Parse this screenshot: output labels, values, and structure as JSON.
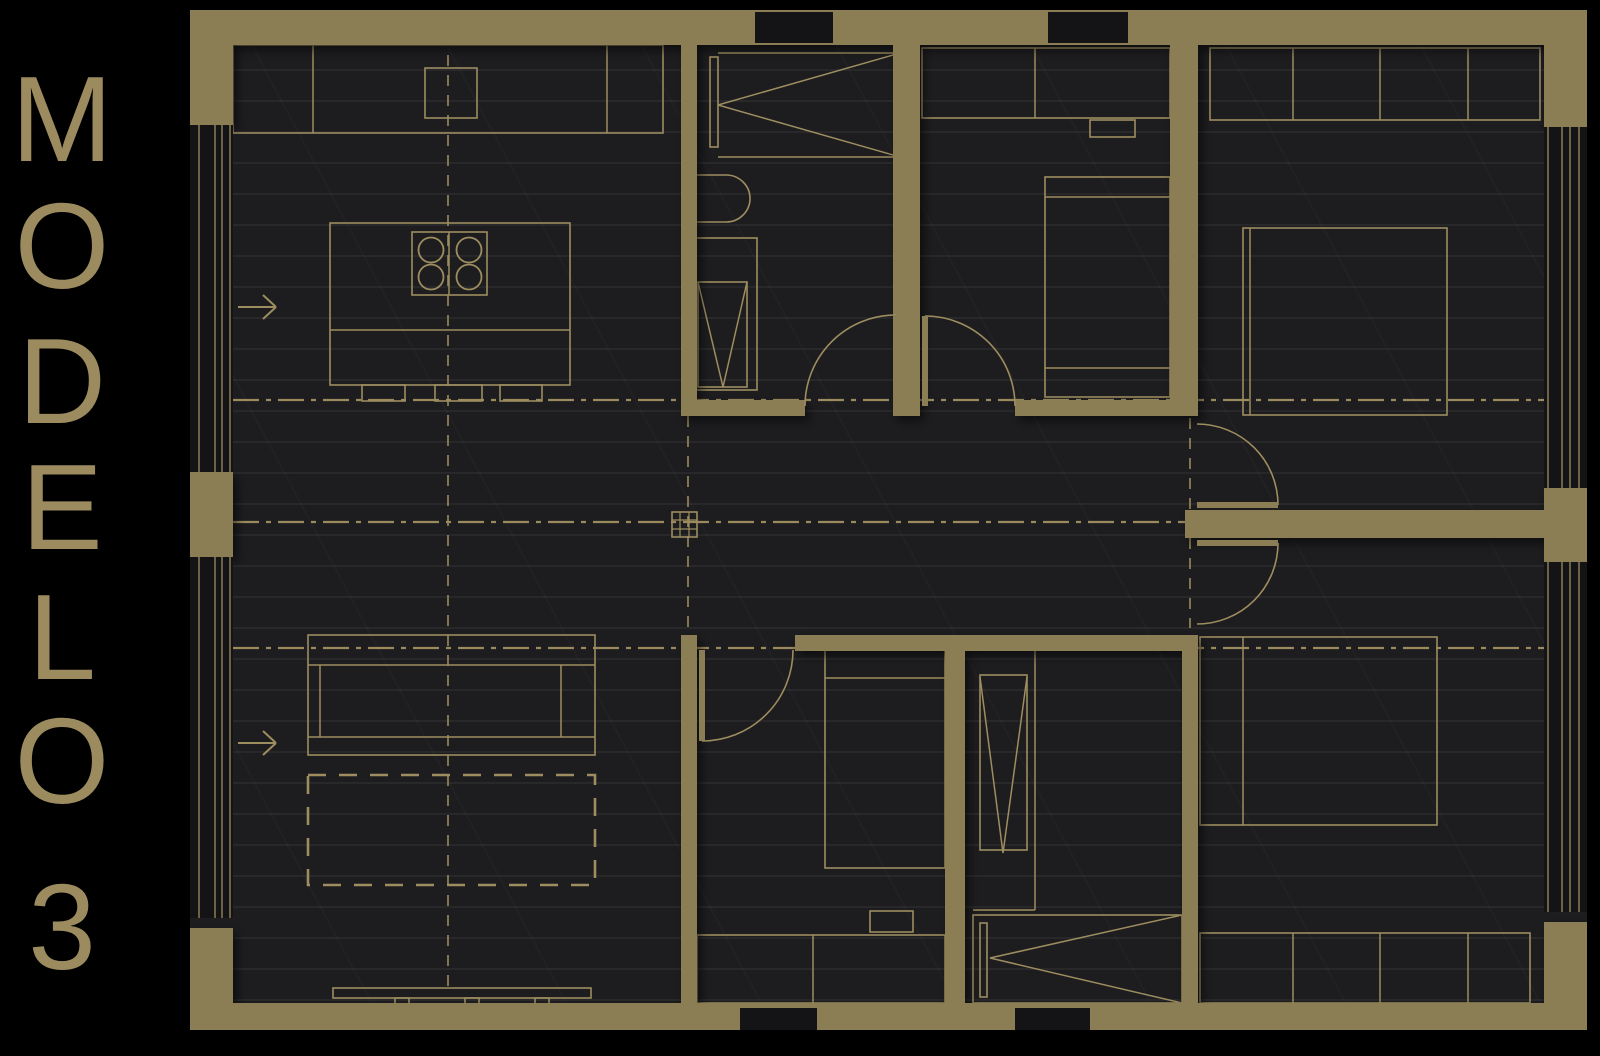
{
  "title": {
    "text": "MODELO 3",
    "color": "#9c8b5e",
    "letters": [
      {
        "ch": "M",
        "y": 58
      },
      {
        "ch": "O",
        "y": 185
      },
      {
        "ch": "D",
        "y": 320
      },
      {
        "ch": "E",
        "y": 446
      },
      {
        "ch": "L",
        "y": 576
      },
      {
        "ch": "O",
        "y": 700
      },
      {
        "ch": "3",
        "y": 866
      }
    ]
  },
  "plan": {
    "width": 1397,
    "height": 1020,
    "colors": {
      "wall": "#8b7e55",
      "line": "#9d8d5f",
      "centerline": "#9a8a5c",
      "floor": "#1d1d20",
      "glass": "#141417",
      "shadow": "rgba(0,0,0,0.55)"
    },
    "walls": [
      {
        "name": "wall-top",
        "x": 0,
        "y": 0,
        "w": 1397,
        "h": 35
      },
      {
        "name": "wall-bottom",
        "x": 0,
        "y": 993,
        "w": 1397,
        "h": 27
      },
      {
        "name": "pier-top-left",
        "x": 0,
        "y": 0,
        "w": 43,
        "h": 115
      },
      {
        "name": "pier-top-right",
        "x": 1354,
        "y": 0,
        "w": 43,
        "h": 117
      },
      {
        "name": "pier-left-mid",
        "x": 0,
        "y": 462,
        "w": 43,
        "h": 85
      },
      {
        "name": "pier-left-bottom",
        "x": 0,
        "y": 918,
        "w": 43,
        "h": 102
      },
      {
        "name": "pier-right-mid",
        "x": 1354,
        "y": 478,
        "w": 43,
        "h": 74
      },
      {
        "name": "pier-right-bottom",
        "x": 1354,
        "y": 912,
        "w": 43,
        "h": 108
      },
      {
        "name": "wall-bath1-left",
        "x": 491,
        "y": 35,
        "w": 16,
        "h": 371
      },
      {
        "name": "wall-bath1-bottom",
        "x": 491,
        "y": 390,
        "w": 124,
        "h": 16
      },
      {
        "name": "wall-bath1-bed2",
        "x": 703,
        "y": 35,
        "w": 27,
        "h": 371
      },
      {
        "name": "wall-bed2-bottom",
        "x": 825,
        "y": 390,
        "w": 165,
        "h": 16
      },
      {
        "name": "wall-bed1-left",
        "x": 980,
        "y": 35,
        "w": 28,
        "h": 371
      },
      {
        "name": "wall-bed4-left",
        "x": 992,
        "y": 625,
        "w": 16,
        "h": 368
      },
      {
        "name": "wall-right-bedrooms-divider",
        "x": 995,
        "y": 500,
        "w": 360,
        "h": 28
      },
      {
        "name": "wall-hall-bottom",
        "x": 605,
        "y": 625,
        "w": 403,
        "h": 16
      },
      {
        "name": "wall-bed3-left",
        "x": 491,
        "y": 625,
        "w": 16,
        "h": 368
      },
      {
        "name": "wall-bed3-bath2",
        "x": 755,
        "y": 640,
        "w": 20,
        "h": 353
      }
    ],
    "glass": [
      {
        "name": "window-top-1",
        "x": 565,
        "y": 2,
        "w": 78,
        "h": 31
      },
      {
        "name": "window-top-2",
        "x": 858,
        "y": 2,
        "w": 80,
        "h": 31
      },
      {
        "name": "window-bottom-1",
        "x": 550,
        "y": 998,
        "w": 77,
        "h": 22
      },
      {
        "name": "window-bottom-2",
        "x": 825,
        "y": 998,
        "w": 75,
        "h": 22
      },
      {
        "name": "glazing-left-1",
        "x": 0,
        "y": 115,
        "w": 43,
        "h": 347
      },
      {
        "name": "glazing-left-2",
        "x": 0,
        "y": 547,
        "w": 43,
        "h": 361
      },
      {
        "name": "glazing-right-1",
        "x": 1354,
        "y": 117,
        "w": 43,
        "h": 361
      },
      {
        "name": "glazing-right-2",
        "x": 1354,
        "y": 552,
        "w": 43,
        "h": 350
      }
    ],
    "window_lines": [
      {
        "x1": 9,
        "y1": 115,
        "x2": 9,
        "y2": 462
      },
      {
        "x1": 25,
        "y1": 115,
        "x2": 25,
        "y2": 462
      },
      {
        "x1": 32,
        "y1": 115,
        "x2": 32,
        "y2": 462
      },
      {
        "x1": 40,
        "y1": 115,
        "x2": 40,
        "y2": 462
      },
      {
        "x1": 9,
        "y1": 547,
        "x2": 9,
        "y2": 908
      },
      {
        "x1": 25,
        "y1": 547,
        "x2": 25,
        "y2": 908
      },
      {
        "x1": 32,
        "y1": 547,
        "x2": 32,
        "y2": 908
      },
      {
        "x1": 40,
        "y1": 547,
        "x2": 40,
        "y2": 908
      },
      {
        "x1": 1358,
        "y1": 117,
        "x2": 1358,
        "y2": 478
      },
      {
        "x1": 1372,
        "y1": 117,
        "x2": 1372,
        "y2": 478
      },
      {
        "x1": 1380,
        "y1": 117,
        "x2": 1380,
        "y2": 478
      },
      {
        "x1": 1389,
        "y1": 117,
        "x2": 1389,
        "y2": 478
      },
      {
        "x1": 1358,
        "y1": 552,
        "x2": 1358,
        "y2": 902
      },
      {
        "x1": 1372,
        "y1": 552,
        "x2": 1372,
        "y2": 902
      },
      {
        "x1": 1380,
        "y1": 552,
        "x2": 1380,
        "y2": 902
      },
      {
        "x1": 1389,
        "y1": 552,
        "x2": 1389,
        "y2": 902
      }
    ],
    "furniture_rects": [
      {
        "name": "kitchen-counter",
        "x": 43,
        "y": 35,
        "w": 430,
        "h": 88
      },
      {
        "name": "kitchen-sink",
        "x": 235,
        "y": 58,
        "w": 52,
        "h": 50
      },
      {
        "name": "kitchen-island",
        "x": 140,
        "y": 213,
        "w": 240,
        "h": 162
      },
      {
        "name": "cooktop",
        "x": 222,
        "y": 222,
        "w": 75,
        "h": 63
      },
      {
        "name": "stool",
        "x": 172,
        "y": 375,
        "w": 43,
        "h": 16
      },
      {
        "name": "stool",
        "x": 245,
        "y": 375,
        "w": 47,
        "h": 16
      },
      {
        "name": "stool",
        "x": 310,
        "y": 375,
        "w": 42,
        "h": 16
      },
      {
        "name": "sofa",
        "x": 118,
        "y": 625,
        "w": 287,
        "h": 120
      },
      {
        "name": "tv-console",
        "x": 143,
        "y": 978,
        "w": 258,
        "h": 10
      },
      {
        "name": "tv-foot",
        "x": 205,
        "y": 988,
        "w": 14,
        "h": 8
      },
      {
        "name": "tv-foot",
        "x": 275,
        "y": 988,
        "w": 14,
        "h": 8
      },
      {
        "name": "tv-foot",
        "x": 345,
        "y": 988,
        "w": 14,
        "h": 8
      },
      {
        "name": "wardrobe-bed2",
        "x": 732,
        "y": 38,
        "w": 248,
        "h": 70
      },
      {
        "name": "nightstand-bed2",
        "x": 900,
        "y": 110,
        "w": 45,
        "h": 17
      },
      {
        "name": "bed2",
        "x": 855,
        "y": 167,
        "w": 125,
        "h": 220
      },
      {
        "name": "wardrobe-bed1",
        "x": 1020,
        "y": 38,
        "w": 330,
        "h": 72
      },
      {
        "name": "bed1",
        "x": 1053,
        "y": 218,
        "w": 204,
        "h": 187
      },
      {
        "name": "bed4",
        "x": 1010,
        "y": 627,
        "w": 237,
        "h": 188
      },
      {
        "name": "wardrobe-bed4",
        "x": 1010,
        "y": 923,
        "w": 330,
        "h": 70
      },
      {
        "name": "bed3",
        "x": 635,
        "y": 640,
        "w": 120,
        "h": 218
      },
      {
        "name": "nightstand-bed3",
        "x": 680,
        "y": 901,
        "w": 43,
        "h": 21
      },
      {
        "name": "wardrobe-bed3",
        "x": 507,
        "y": 925,
        "w": 248,
        "h": 68
      },
      {
        "name": "shower1-enclosure",
        "x": 505,
        "y": 228,
        "w": 62,
        "h": 152
      },
      {
        "name": "shower1-tray",
        "x": 508,
        "y": 272,
        "w": 49,
        "h": 105
      },
      {
        "name": "shower2-tray",
        "x": 790,
        "y": 665,
        "w": 47,
        "h": 175
      },
      {
        "name": "bath2-unit",
        "x": 783,
        "y": 905,
        "w": 209,
        "h": 88
      },
      {
        "name": "bath2-unit-panel",
        "x": 790,
        "y": 913,
        "w": 7,
        "h": 74
      },
      {
        "name": "bath1-closet-panel",
        "x": 520,
        "y": 47,
        "w": 8,
        "h": 90
      }
    ],
    "furniture_lines": [
      {
        "x1": 123,
        "y1": 35,
        "x2": 123,
        "y2": 123
      },
      {
        "x1": 417,
        "y1": 35,
        "x2": 417,
        "y2": 123
      },
      {
        "x1": 140,
        "y1": 320,
        "x2": 380,
        "y2": 320
      },
      {
        "x1": 259,
        "y1": 222,
        "x2": 259,
        "y2": 285
      },
      {
        "x1": 118,
        "y1": 655,
        "x2": 405,
        "y2": 655
      },
      {
        "x1": 118,
        "y1": 727,
        "x2": 405,
        "y2": 727
      },
      {
        "x1": 130,
        "y1": 655,
        "x2": 130,
        "y2": 727
      },
      {
        "x1": 371,
        "y1": 655,
        "x2": 371,
        "y2": 727
      },
      {
        "x1": 855,
        "y1": 187,
        "x2": 980,
        "y2": 187
      },
      {
        "x1": 855,
        "y1": 358,
        "x2": 980,
        "y2": 358
      },
      {
        "x1": 1060,
        "y1": 218,
        "x2": 1060,
        "y2": 405
      },
      {
        "x1": 1053,
        "y1": 627,
        "x2": 1053,
        "y2": 815
      },
      {
        "x1": 635,
        "y1": 668,
        "x2": 755,
        "y2": 668
      },
      {
        "x1": 845,
        "y1": 38,
        "x2": 845,
        "y2": 108
      },
      {
        "x1": 1103,
        "y1": 38,
        "x2": 1103,
        "y2": 110
      },
      {
        "x1": 1190,
        "y1": 38,
        "x2": 1190,
        "y2": 110
      },
      {
        "x1": 1278,
        "y1": 38,
        "x2": 1278,
        "y2": 110
      },
      {
        "x1": 1103,
        "y1": 923,
        "x2": 1103,
        "y2": 993
      },
      {
        "x1": 1190,
        "y1": 923,
        "x2": 1190,
        "y2": 993
      },
      {
        "x1": 1278,
        "y1": 923,
        "x2": 1278,
        "y2": 993
      },
      {
        "x1": 623,
        "y1": 925,
        "x2": 623,
        "y2": 993
      },
      {
        "x1": 528,
        "y1": 43,
        "x2": 710,
        "y2": 43
      },
      {
        "x1": 528,
        "y1": 147,
        "x2": 710,
        "y2": 147
      },
      {
        "x1": 710,
        "y1": 43,
        "x2": 710,
        "y2": 147
      },
      {
        "x1": 710,
        "y1": 43,
        "x2": 528,
        "y2": 95
      },
      {
        "x1": 710,
        "y1": 147,
        "x2": 528,
        "y2": 95
      },
      {
        "x1": 508,
        "y1": 272,
        "x2": 533,
        "y2": 377
      },
      {
        "x1": 557,
        "y1": 272,
        "x2": 533,
        "y2": 377
      },
      {
        "x1": 845,
        "y1": 640,
        "x2": 845,
        "y2": 900
      },
      {
        "x1": 783,
        "y1": 900,
        "x2": 845,
        "y2": 900
      },
      {
        "x1": 790,
        "y1": 667,
        "x2": 813,
        "y2": 843
      },
      {
        "x1": 837,
        "y1": 667,
        "x2": 813,
        "y2": 843
      },
      {
        "x1": 992,
        "y1": 905,
        "x2": 800,
        "y2": 948
      },
      {
        "x1": 992,
        "y1": 993,
        "x2": 800,
        "y2": 948
      },
      {
        "x1": 565,
        "y1": 31,
        "x2": 643,
        "y2": 31
      },
      {
        "x1": 858,
        "y1": 31,
        "x2": 938,
        "y2": 31
      },
      {
        "x1": 550,
        "y1": 998,
        "x2": 627,
        "y2": 998
      },
      {
        "x1": 825,
        "y1": 998,
        "x2": 900,
        "y2": 998
      }
    ],
    "paths": [
      {
        "name": "bath1-fixture",
        "d": "M507,165 h29 a24,23.5 0 0 1 0,47 h-29"
      }
    ],
    "circles": [
      {
        "name": "burner",
        "cx": 241,
        "cy": 240,
        "r": 12.5
      },
      {
        "name": "burner",
        "cx": 279,
        "cy": 240,
        "r": 12.5
      },
      {
        "name": "burner",
        "cx": 241,
        "cy": 267,
        "r": 12.5
      },
      {
        "name": "burner",
        "cx": 279,
        "cy": 267,
        "r": 12.5
      }
    ],
    "rug": {
      "name": "rug",
      "x": 118,
      "y": 765,
      "w": 287,
      "h": 110
    },
    "doors": [
      {
        "name": "door-bath1",
        "arc": "M615,396 A91,91 0 0 1 706,305",
        "leaf": {
          "x1": 706,
          "y1": 305,
          "x2": 706,
          "y2": 396
        }
      },
      {
        "name": "door-bed2",
        "arc": "M735,306 A90,90 0 0 1 825,396",
        "leaf": {
          "x1": 735,
          "y1": 306,
          "x2": 735,
          "y2": 396
        }
      },
      {
        "name": "door-bed3",
        "arc": "M512,731 A91,91 0 0 0 603,640",
        "leaf": {
          "x1": 512,
          "y1": 640,
          "x2": 512,
          "y2": 731
        }
      },
      {
        "name": "door-bed1",
        "arc": "M1088,495 A81,81 0 0 0 1007,414",
        "leaf": {
          "x1": 1007,
          "y1": 495,
          "x2": 1088,
          "y2": 495
        }
      },
      {
        "name": "door-bed4",
        "arc": "M1088,533 A81,81 0 0 1 1007,614",
        "leaf": {
          "x1": 1007,
          "y1": 533,
          "x2": 1088,
          "y2": 533
        }
      }
    ],
    "centerlines": [
      {
        "type": "dashdot",
        "x1": 43,
        "y1": 390,
        "x2": 1355,
        "y2": 390
      },
      {
        "type": "dashdot",
        "x1": 43,
        "y1": 512,
        "x2": 1355,
        "y2": 512
      },
      {
        "type": "dashdot",
        "x1": 43,
        "y1": 638,
        "x2": 1355,
        "y2": 638
      },
      {
        "type": "dash",
        "x1": 258,
        "y1": 45,
        "x2": 258,
        "y2": 978
      },
      {
        "type": "dash",
        "x1": 498,
        "y1": 406,
        "x2": 498,
        "y2": 625
      },
      {
        "type": "dash",
        "x1": 1000,
        "y1": 408,
        "x2": 1000,
        "y2": 618
      }
    ],
    "column_marker": {
      "x": 482,
      "y": 502,
      "size": 25
    },
    "arrows": [
      {
        "x": 48,
        "y": 297,
        "len": 38
      },
      {
        "x": 48,
        "y": 733,
        "len": 38
      }
    ]
  }
}
